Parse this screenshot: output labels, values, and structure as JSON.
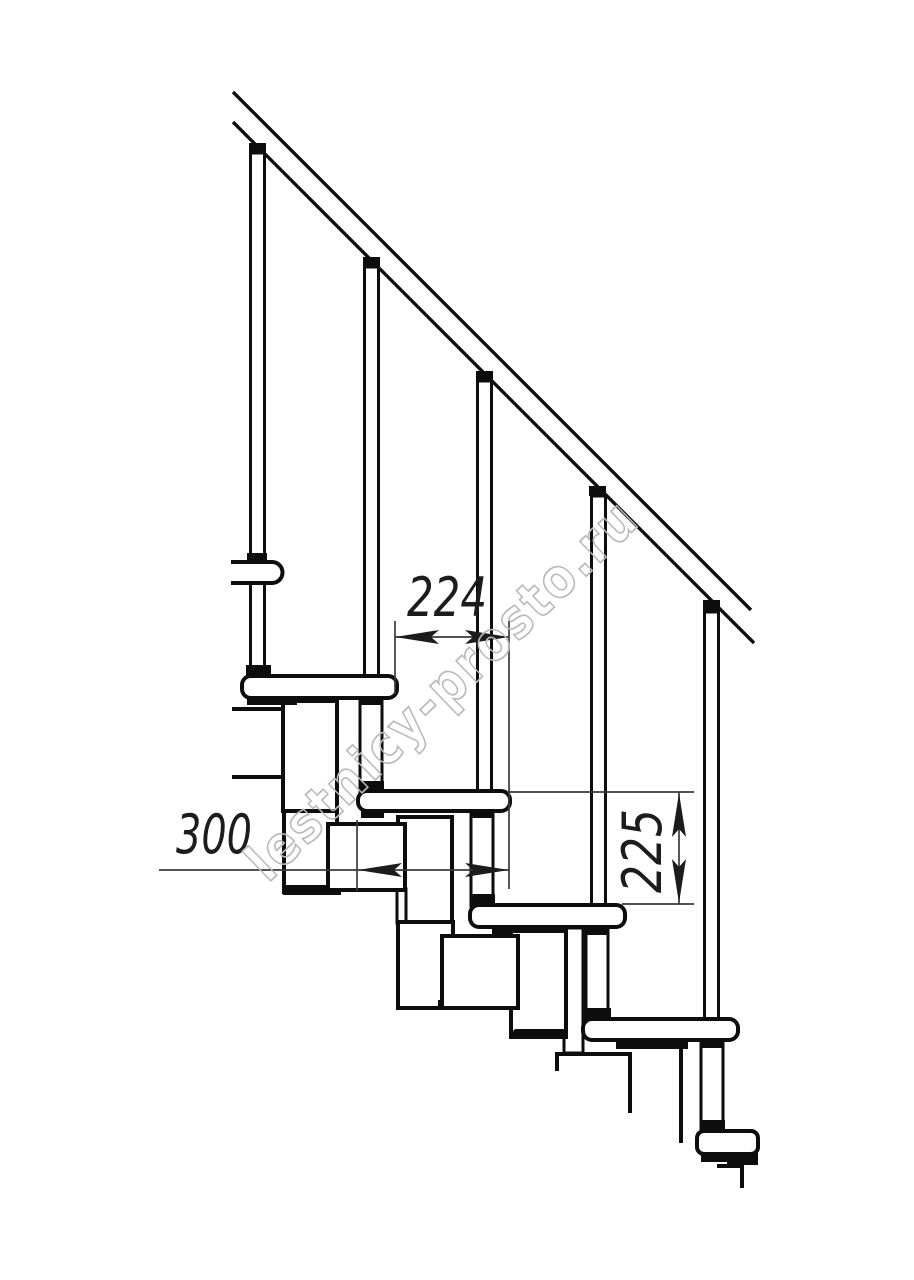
{
  "colors": {
    "background": "#ffffff",
    "line": "#0d0d0d",
    "dimension": "#3a3a3a",
    "watermark": "#b9b9b9"
  },
  "watermark": {
    "text": "lestnicy-prosto.ru"
  },
  "dimensions": {
    "run": {
      "value": "224"
    },
    "depth": {
      "value": "300"
    },
    "rise": {
      "value": "225"
    }
  }
}
